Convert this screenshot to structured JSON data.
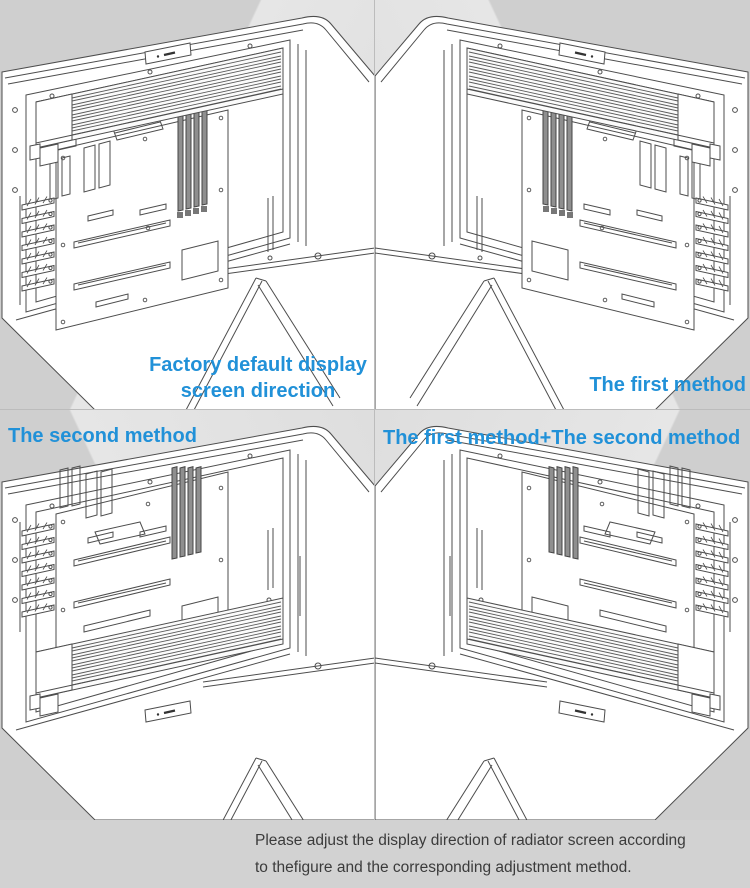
{
  "page": {
    "width": 750,
    "height": 888
  },
  "panels": [
    {
      "id": "factory-default",
      "label_lines": [
        "Factory default display",
        "screen direction"
      ],
      "radiator_position": "top",
      "mirrored": false,
      "label_align": "center"
    },
    {
      "id": "first-method",
      "label_lines": [
        "The first method"
      ],
      "radiator_position": "top",
      "mirrored": true,
      "label_align": "right"
    },
    {
      "id": "second-method",
      "label_lines": [
        "The second method"
      ],
      "radiator_position": "bottom",
      "mirrored": false,
      "label_align": "left"
    },
    {
      "id": "first-plus-second-method",
      "label_lines": [
        "The first method+The second method"
      ],
      "radiator_position": "bottom",
      "mirrored": true,
      "label_align": "left"
    }
  ],
  "caption": {
    "lines": [
      "Please adjust the display direction of radiator screen according",
      "to thefigure and the corresponding adjustment method."
    ]
  },
  "colors": {
    "label_blue": "#2191d8",
    "caption_text": "#3b3b3b",
    "background_gray": "#cfcfcf",
    "background_light": "#e6e6e6",
    "line_art": "#4d4d4d",
    "case_white": "#ffffff"
  }
}
